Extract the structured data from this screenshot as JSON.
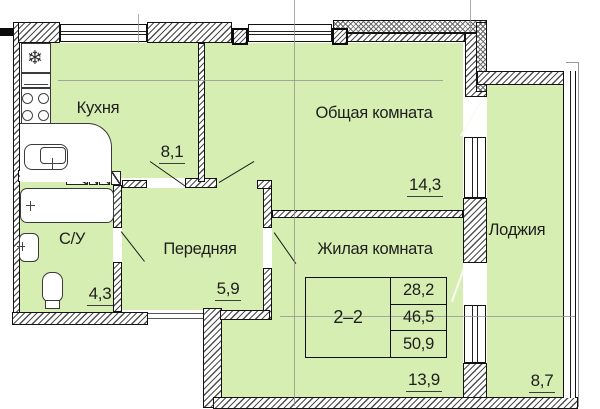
{
  "plan": {
    "rooms": [
      {
        "name": "Кухня",
        "area": "8,1"
      },
      {
        "name": "Общая комната",
        "area": "14,3"
      },
      {
        "name": "Жилая комната",
        "area": "13,9"
      },
      {
        "name": "Передняя",
        "area": "5,9"
      },
      {
        "name": "С/У",
        "area": "4,3"
      },
      {
        "name": "Лоджия",
        "area": "8,7"
      }
    ],
    "summary_table": {
      "unit": "2–2",
      "values": [
        "28,2",
        "46,5",
        "50,9"
      ]
    },
    "icons": {
      "fridge_snowflake": "❄"
    },
    "colors": {
      "floor_fill": "#d7eeb2",
      "wall_outline": "#141414",
      "hatch_line": "#4f4f4f"
    }
  }
}
